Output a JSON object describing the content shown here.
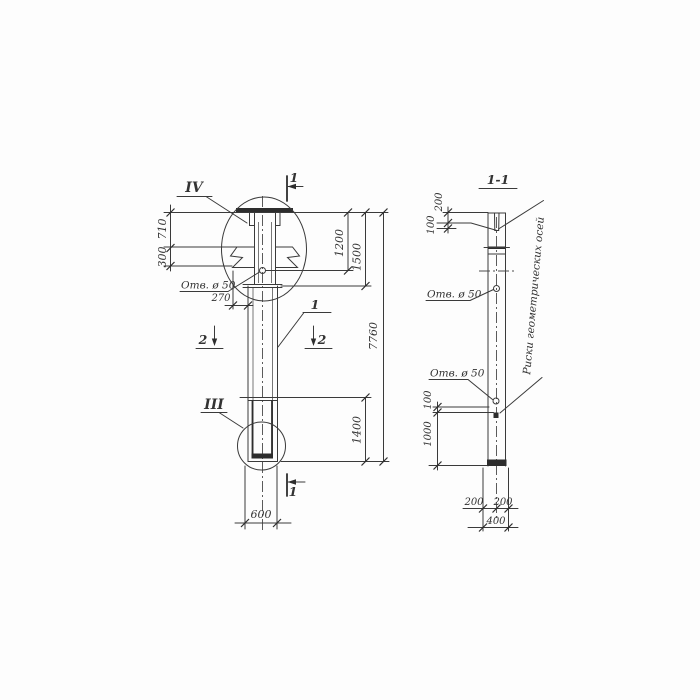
{
  "front_view": {
    "detail_mark_top": "IV",
    "detail_mark_bottom": "III",
    "section_cut_top": "1",
    "section_cut_bottom": "1",
    "section_cut_2_left": "2",
    "section_cut_2_right": "2",
    "position_label": "1",
    "hole_label": "Отв. ø 50",
    "dim_710": "710",
    "dim_300": "300",
    "dim_270": "270",
    "dim_1200": "1200",
    "dim_1500": "1500",
    "dim_7760": "7760",
    "dim_1400": "1400",
    "dim_600": "600"
  },
  "section_view": {
    "title": "1-1",
    "dim_200_top": "200",
    "dim_100_top": "100",
    "dim_100_bottom": "100",
    "dim_1000": "1000",
    "dim_200_left": "200",
    "dim_200_right": "200",
    "dim_400": "400",
    "hole_label_top": "Отв. ø 50",
    "hole_label_bottom": "Отв. ø 50",
    "axis_note": "Риски геометрических осей"
  },
  "colors": {
    "line": "#3a3a3a",
    "background": "#fdfdfd"
  }
}
